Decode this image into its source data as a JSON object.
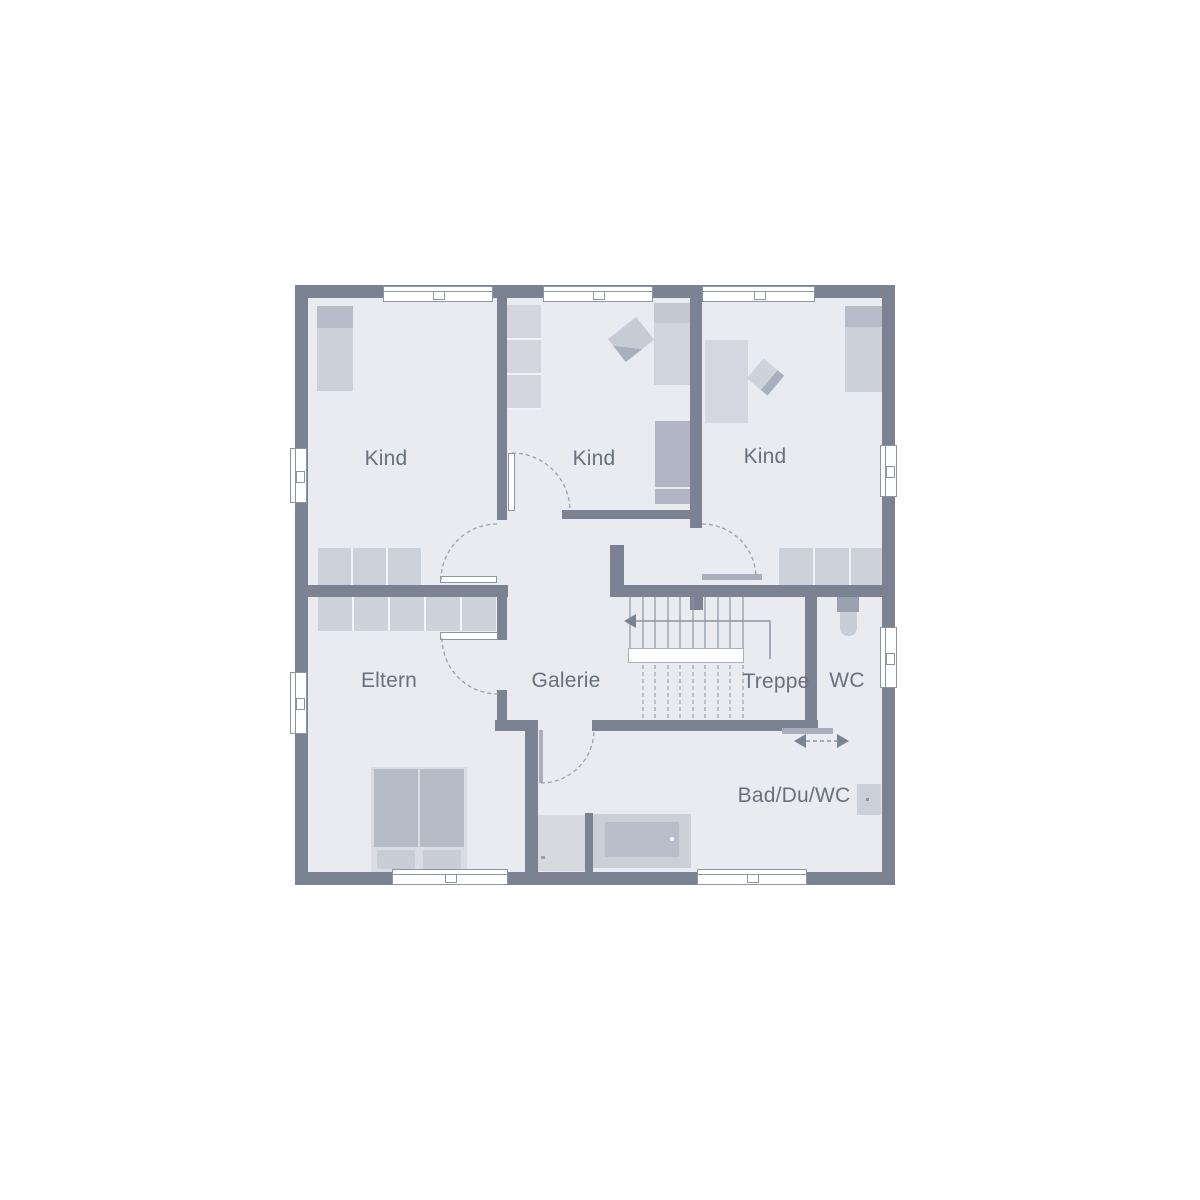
{
  "plan": {
    "rooms": [
      {
        "id": "kind-1",
        "label": "Kind"
      },
      {
        "id": "kind-2",
        "label": "Kind"
      },
      {
        "id": "kind-3",
        "label": "Kind"
      },
      {
        "id": "eltern",
        "label": "Eltern"
      },
      {
        "id": "galerie",
        "label": "Galerie"
      },
      {
        "id": "treppe",
        "label": "Treppe"
      },
      {
        "id": "wc",
        "label": "WC"
      },
      {
        "id": "bad-du-wc",
        "label": "Bad/Du/WC"
      }
    ],
    "colors": {
      "wall": "#7b8393",
      "floor": "#e9ebf1",
      "background": "#ffffff",
      "furniture_light": "#cdd1da",
      "furniture_medium": "#b5bbc7",
      "furniture_dark": "#9aa0af",
      "line": "#8e96a4",
      "label_text": "#68707f"
    }
  }
}
